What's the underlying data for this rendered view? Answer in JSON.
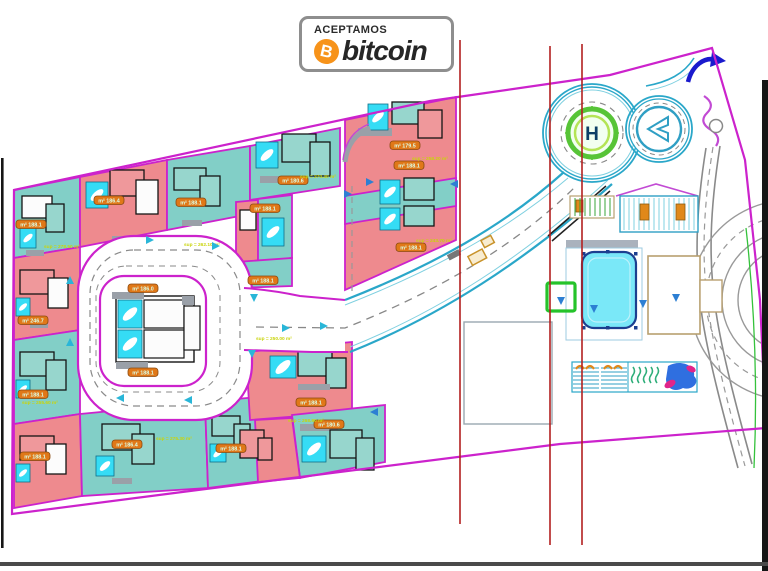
{
  "banner": {
    "kicker": "ACEPTAMOS",
    "brand": "bitcoin",
    "symbol": "B"
  },
  "plan": {
    "helipad_letter": "H",
    "lot_labels": [
      "m² 188.1",
      "m² 186.4",
      "m² 188.1",
      "m² 180.6",
      "m² 188.1",
      "m² 188.1",
      "m² 186.0",
      "m² 188.1",
      "m² 179.5",
      "m² 188.1",
      "m² 188.1",
      "m² 246.7",
      "m² 188.1",
      "m² 186.4",
      "m² 188.1",
      "m² 188.1",
      "m² 180.6",
      "m² 188.1"
    ],
    "area_notes": [
      "sup = 278.50 m²",
      "sup = 262.10 m²",
      "sup = 270.40 m²",
      "sup = 258.20 m²",
      "sup = 243.70 m²",
      "sup = 250.00 m²",
      "sup = 275.30 m²",
      "sup = 268.90 m²",
      "sup = 255.60 m²"
    ]
  },
  "colors": {
    "lot_pink": "#ee8a8e",
    "lot_teal": "#82cfc7",
    "boundary": "#cc22cc",
    "pool_cyan": "#35dcf5",
    "road_edge": "#2aa7c9",
    "section_line": "#b32020",
    "label_bg": "#e07818",
    "label_text": "#dbffe9",
    "note_text": "#c9d40a",
    "helipad_green": "#57c437",
    "marker_green": "#25c32a",
    "arrow_blue": "#2d7fd3",
    "bitcoin_orange": "#f7931a"
  }
}
